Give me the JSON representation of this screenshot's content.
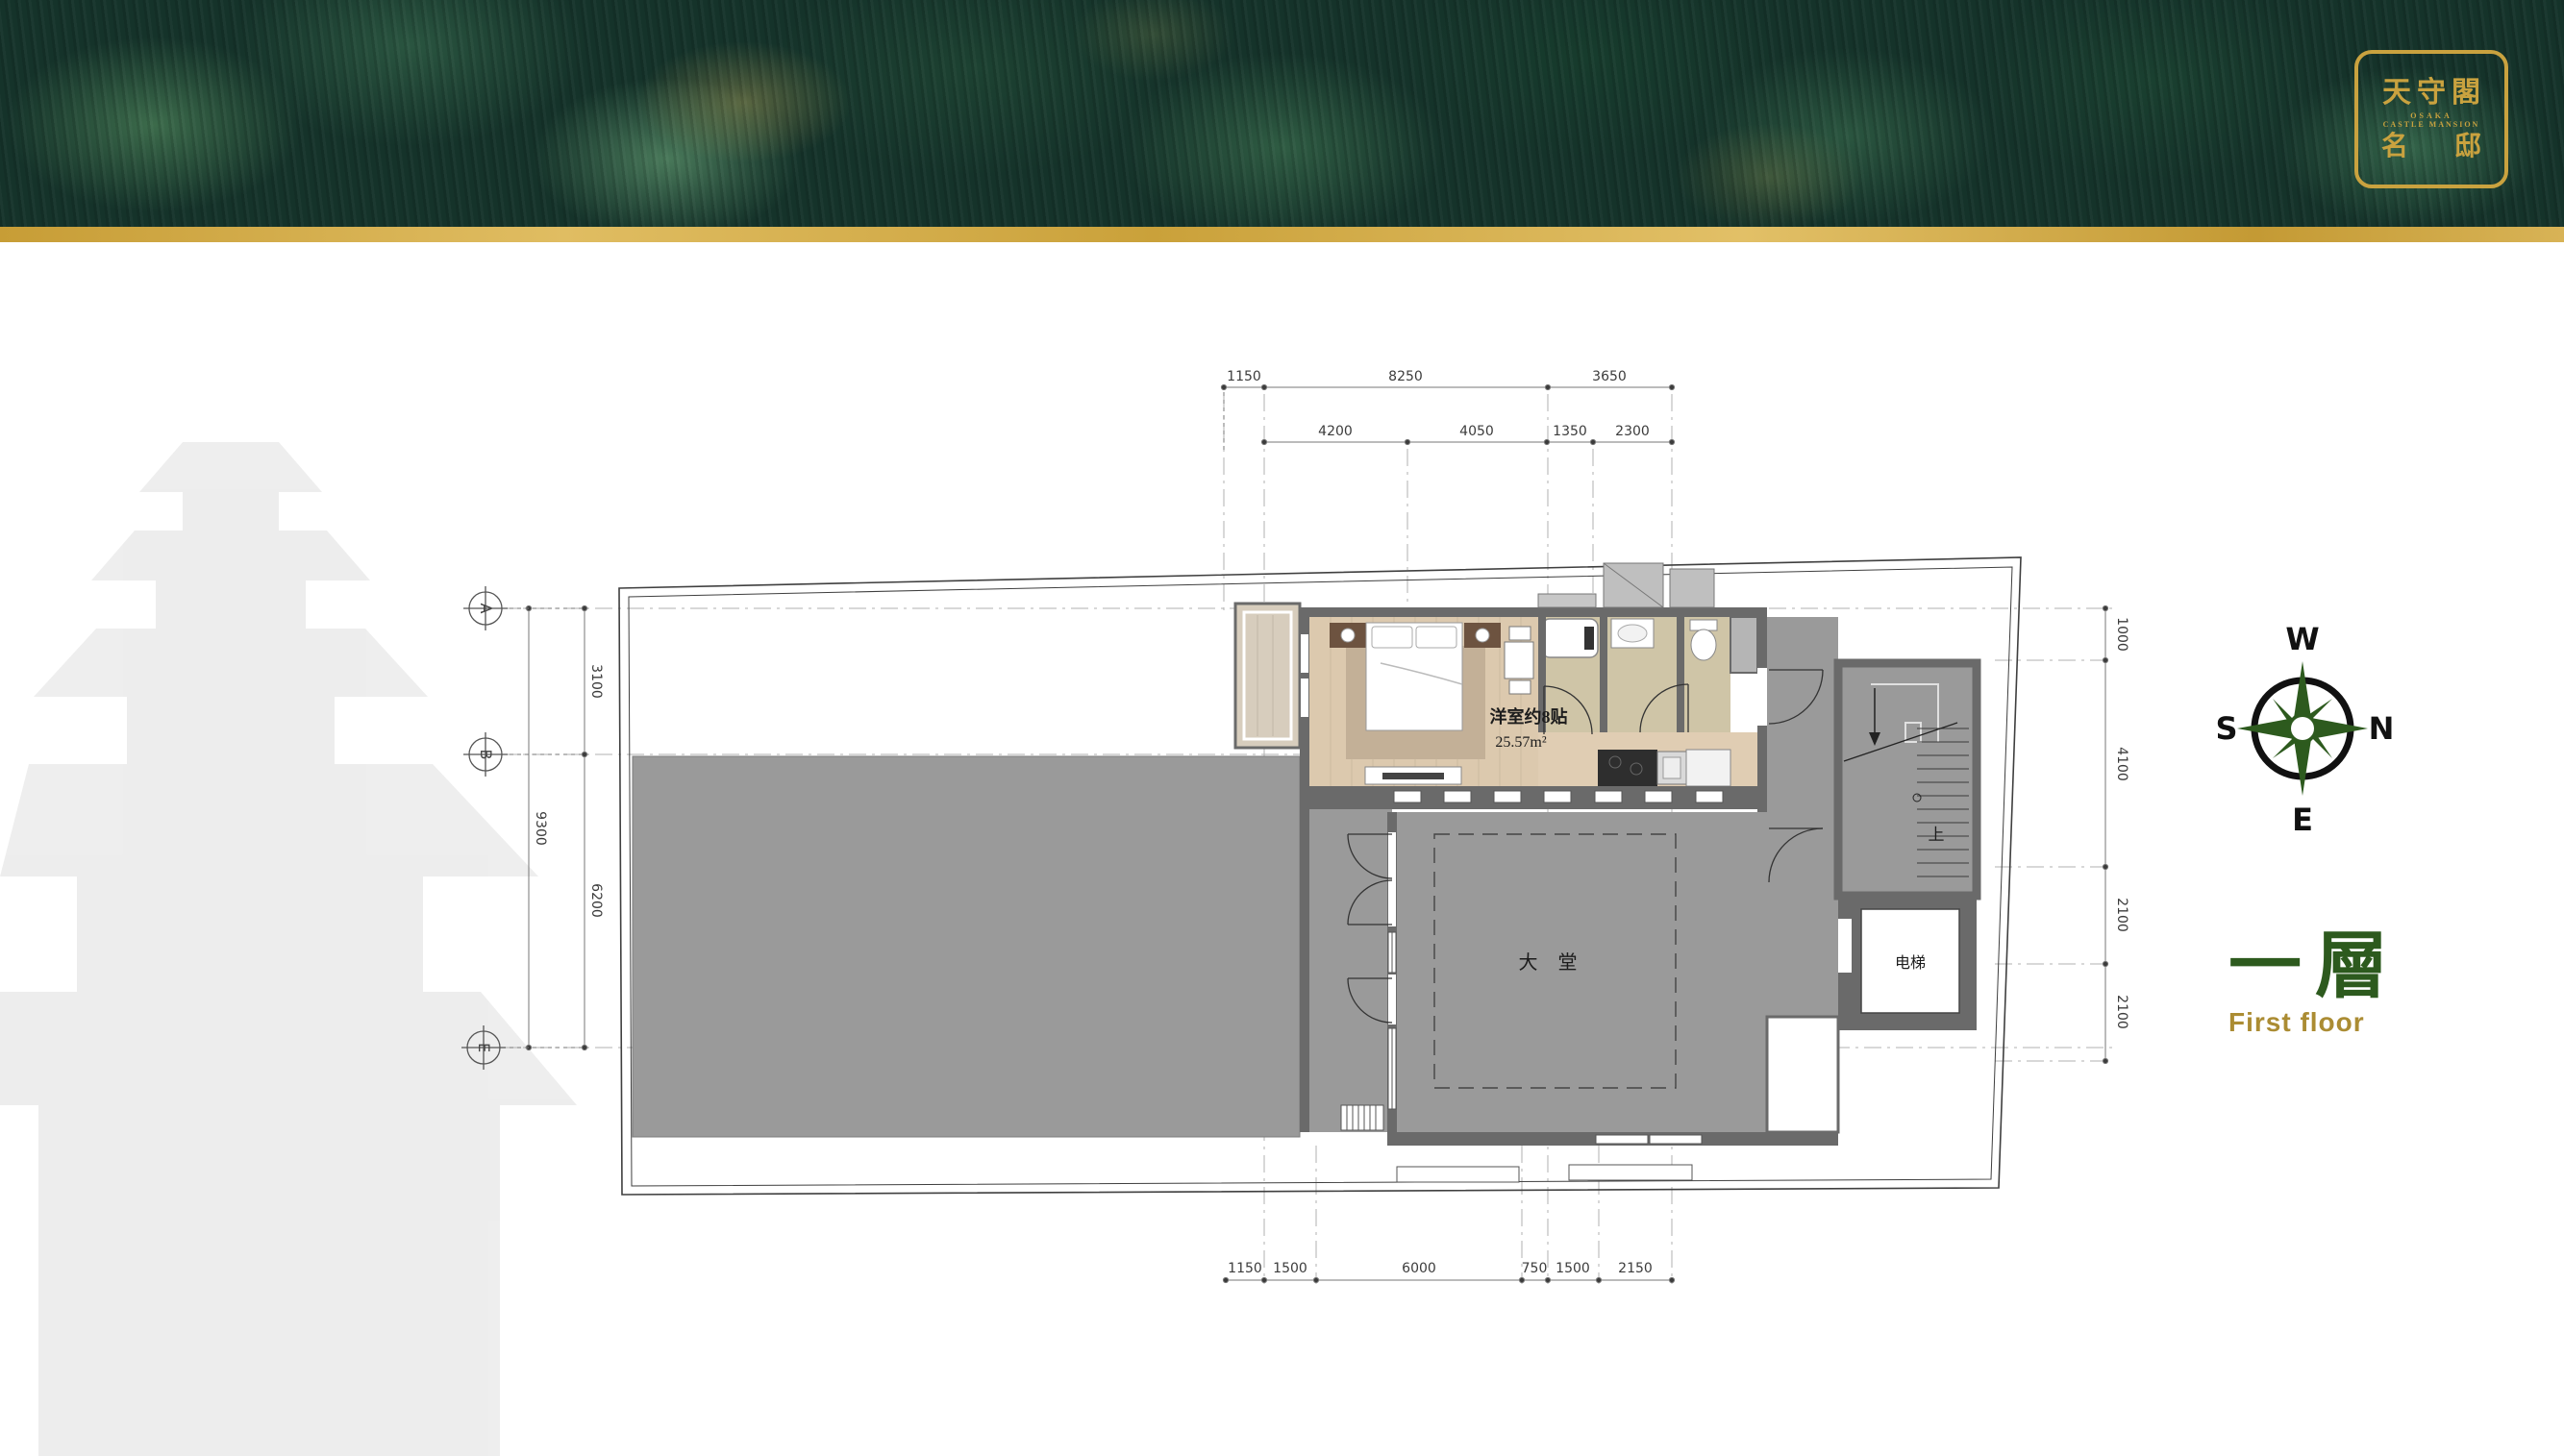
{
  "logo": {
    "title": "天守閣",
    "subtitle1": "OSAKA",
    "subtitle2": "CASTLE MANSION",
    "name_left": "名",
    "name_right": "邸"
  },
  "compass": {
    "west": "W",
    "north": "N",
    "south": "S",
    "east": "E"
  },
  "floor_label": {
    "cn": "一層",
    "en": "First floor"
  },
  "plan": {
    "room_labels": {
      "bedroom": "洋室约8贴",
      "bedroom_area": "25.57m²",
      "lobby": "大 堂",
      "elevator": "电梯",
      "stair_up": "上"
    },
    "grid_bubbles": {
      "a": "A",
      "b": "B",
      "e": "E"
    },
    "dims": {
      "top_row1": [
        "1150",
        "8250",
        "3650"
      ],
      "top_row2": [
        "4200",
        "4050",
        "1350",
        "2300"
      ],
      "left_outer": [
        "9300"
      ],
      "left_inner": [
        "3100",
        "6200"
      ],
      "right": [
        "1000",
        "4100",
        "2100",
        "2100"
      ],
      "bottom": [
        "1150",
        "1500",
        "6000",
        "750",
        "1500",
        "2150"
      ]
    },
    "colors": {
      "wall": "#6a6a6a",
      "floor_gray": "#9a9a9a",
      "wood": "#dcc9ae",
      "tatami": "#cfc5a7",
      "accent_green": "#2d5a1e",
      "accent_gold": "#ab8c33",
      "gold_bar": "#caa13a",
      "logo_gold": "#c9a23f"
    }
  }
}
